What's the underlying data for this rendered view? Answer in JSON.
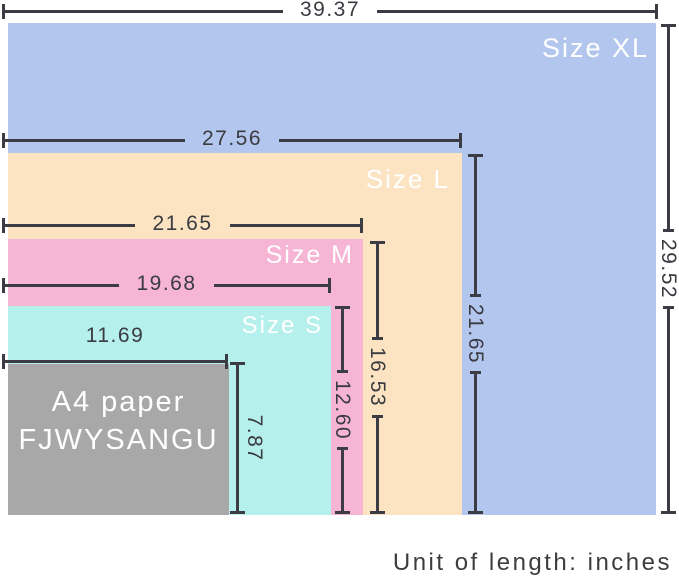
{
  "unit_note": "Unit of length: inches",
  "sizes": [
    {
      "label": "Size XL",
      "width_in": "39.37",
      "height_in": "29.52",
      "color": "#b3c7ee"
    },
    {
      "label": "Size L",
      "width_in": "27.56",
      "height_in": "21.65",
      "color": "#fce4c3"
    },
    {
      "label": "Size M",
      "width_in": "21.65",
      "height_in": "16.53",
      "color": "#f7b5d6"
    },
    {
      "label": "Size S",
      "width_in": "19.68",
      "height_in": "12.60",
      "color": "#b6f0ec"
    },
    {
      "label": "A4 paper",
      "brand": "FJWYSANGU",
      "width_in": "11.69",
      "height_in": "7.87",
      "color": "#a8a8a8"
    }
  ],
  "line_color": "#3c3c44",
  "number_text_color": "#3a3a41",
  "label_text_color": "#ffffff"
}
